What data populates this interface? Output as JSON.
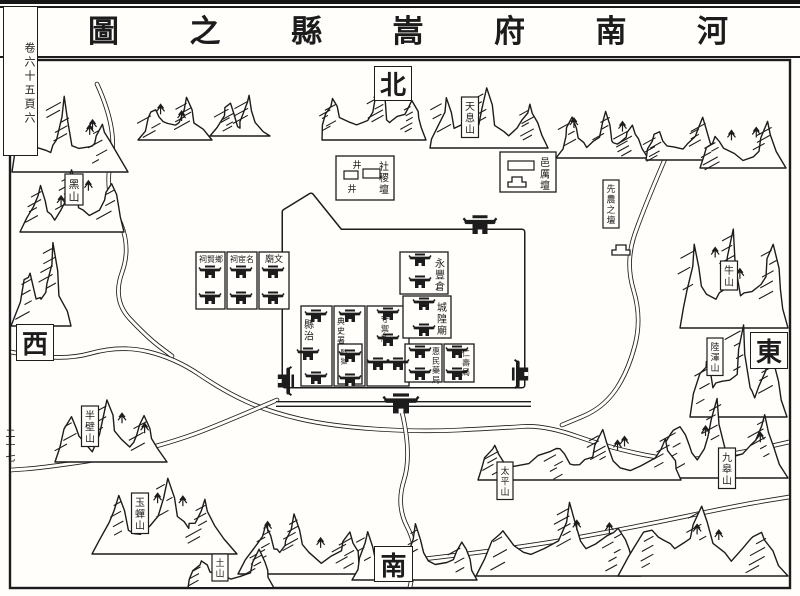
{
  "title": {
    "full": "河南府嵩縣之圖",
    "reading": "right-to-left",
    "display_chars": [
      "圖",
      "之",
      "縣",
      "嵩",
      "府",
      "南",
      "河"
    ]
  },
  "margins": {
    "folio_top": "卷六十五頁六",
    "folio_side": "二十七"
  },
  "compass": {
    "north": "北",
    "south": "南",
    "west": "西",
    "east": "東"
  },
  "ink": "#1c1c1c",
  "paper": "#fffefb",
  "map": {
    "frame": [
      10,
      60,
      780,
      528
    ],
    "wall_points": [
      [
        285,
        212
      ],
      [
        311,
        196
      ],
      [
        340,
        232
      ],
      [
        522,
        232
      ],
      [
        522,
        385
      ],
      [
        285,
        385
      ]
    ],
    "moat_points": [
      [
        276,
        404
      ],
      [
        531,
        404
      ]
    ],
    "compound_rects": [
      [
        196,
        252,
        29,
        57
      ],
      [
        227,
        252,
        30,
        57
      ],
      [
        259,
        252,
        30,
        57
      ],
      [
        301,
        306,
        31,
        80
      ],
      [
        334,
        306,
        31,
        80
      ],
      [
        367,
        306,
        42,
        80
      ],
      [
        338,
        344,
        24,
        40
      ],
      [
        400,
        252,
        48,
        42
      ],
      [
        403,
        296,
        48,
        42
      ],
      [
        405,
        344,
        37,
        38
      ],
      [
        444,
        344,
        30,
        38
      ],
      [
        336,
        156,
        58,
        44
      ],
      [
        500,
        152,
        56,
        40
      ]
    ],
    "labels_vertical": [
      {
        "t": "縣治",
        "x": 309,
        "y": 318,
        "fs": 10
      },
      {
        "t": "典史署",
        "x": 341,
        "y": 316,
        "fs": 8
      },
      {
        "t": "監獄",
        "x": 344,
        "y": 348,
        "fs": 7
      },
      {
        "t": "守禦所",
        "x": 385,
        "y": 314,
        "fs": 8
      },
      {
        "t": "永豐倉",
        "x": 440,
        "y": 257,
        "fs": 10
      },
      {
        "t": "城隍廟",
        "x": 442,
        "y": 301,
        "fs": 10
      },
      {
        "t": "惠民藥局",
        "x": 436,
        "y": 346,
        "fs": 8
      },
      {
        "t": "仁壽局",
        "x": 466,
        "y": 348,
        "fs": 8
      },
      {
        "t": "社稷壇",
        "x": 384,
        "y": 160,
        "fs": 10
      },
      {
        "t": "邑厲壇",
        "x": 545,
        "y": 156,
        "fs": 10
      }
    ],
    "labels_horizontal_rtl": [
      {
        "t": "文廟",
        "x": 274,
        "y": 262,
        "fs": 9
      },
      {
        "t": "名宦祠",
        "x": 242,
        "y": 262,
        "fs": 8
      },
      {
        "t": "鄉賢祠",
        "x": 211,
        "y": 262,
        "fs": 8
      }
    ],
    "cartouches": [
      {
        "t": "黑山",
        "x": 74,
        "y": 177,
        "fs": 11
      },
      {
        "t": "天息山",
        "x": 470,
        "y": 100,
        "fs": 10
      },
      {
        "t": "牛山",
        "x": 729,
        "y": 264,
        "fs": 10
      },
      {
        "t": "陸渾山",
        "x": 715,
        "y": 341,
        "fs": 9
      },
      {
        "t": "九皋山",
        "x": 727,
        "y": 451,
        "fs": 10
      },
      {
        "t": "太平山",
        "x": 505,
        "y": 465,
        "fs": 9
      },
      {
        "t": "半壁山",
        "x": 90,
        "y": 409,
        "fs": 10
      },
      {
        "t": "玉蟬山",
        "x": 140,
        "y": 496,
        "fs": 10
      },
      {
        "t": "土山",
        "x": 220,
        "y": 557,
        "fs": 9
      },
      {
        "t": "先農之壇",
        "x": 611,
        "y": 183,
        "fs": 9
      }
    ],
    "wells": {
      "glyph": "井",
      "positions": [
        [
          357,
          168
        ],
        [
          352,
          192
        ]
      ]
    },
    "altar_positions": [
      [
        517,
        180
      ],
      [
        621,
        248
      ]
    ],
    "small_rects": [
      [
        344,
        171,
        14,
        8
      ],
      [
        363,
        169,
        17,
        9
      ],
      [
        508,
        161,
        26,
        9
      ]
    ],
    "buildings": [
      [
        210,
        274
      ],
      [
        210,
        300
      ],
      [
        241,
        274
      ],
      [
        241,
        300
      ],
      [
        273,
        274
      ],
      [
        273,
        300
      ],
      [
        316,
        318
      ],
      [
        308,
        356
      ],
      [
        316,
        380
      ],
      [
        350,
        318
      ],
      [
        350,
        358
      ],
      [
        350,
        382
      ],
      [
        388,
        316
      ],
      [
        388,
        342
      ],
      [
        378,
        366
      ],
      [
        398,
        366
      ],
      [
        420,
        262
      ],
      [
        420,
        284
      ],
      [
        424,
        306
      ],
      [
        424,
        332
      ],
      [
        420,
        354
      ],
      [
        420,
        376
      ],
      [
        457,
        354
      ],
      [
        457,
        376
      ]
    ],
    "gates": [
      [
        480,
        228,
        1.5,
        0
      ],
      [
        283,
        381,
        1.3,
        90
      ],
      [
        523,
        374,
        1.3,
        -90
      ],
      [
        401,
        407,
        1.6,
        0
      ]
    ],
    "mountains": [
      [
        12,
        94,
        116,
        78,
        3,
        11,
        1
      ],
      [
        20,
        168,
        104,
        64,
        3,
        5,
        1
      ],
      [
        11,
        240,
        60,
        86,
        2,
        9,
        0
      ],
      [
        138,
        96,
        74,
        44,
        2,
        4,
        1
      ],
      [
        210,
        94,
        60,
        42,
        2,
        13,
        0
      ],
      [
        322,
        86,
        104,
        54,
        3,
        6,
        0
      ],
      [
        430,
        86,
        118,
        62,
        3,
        7,
        0
      ],
      [
        556,
        110,
        92,
        48,
        3,
        8,
        1
      ],
      [
        646,
        116,
        74,
        44,
        2,
        3,
        0
      ],
      [
        700,
        120,
        86,
        48,
        2,
        10,
        1
      ],
      [
        680,
        226,
        108,
        102,
        3,
        14,
        1
      ],
      [
        690,
        322,
        97,
        95,
        3,
        15,
        0
      ],
      [
        652,
        396,
        136,
        82,
        3,
        16,
        1
      ],
      [
        478,
        428,
        203,
        52,
        4,
        17,
        1
      ],
      [
        55,
        398,
        112,
        64,
        3,
        18,
        1
      ],
      [
        92,
        476,
        145,
        78,
        3,
        19,
        1
      ],
      [
        238,
        512,
        125,
        62,
        3,
        20,
        1
      ],
      [
        352,
        522,
        125,
        58,
        3,
        21,
        0
      ],
      [
        476,
        500,
        165,
        76,
        3,
        22,
        1
      ],
      [
        618,
        504,
        170,
        72,
        3,
        23,
        1
      ],
      [
        188,
        548,
        86,
        40,
        2,
        24,
        0
      ],
      [
        310,
        236,
        40,
        20,
        2,
        25,
        0
      ]
    ],
    "rivers": [
      [
        [
          97,
          84
        ],
        [
          118,
          130
        ],
        [
          104,
          190
        ],
        [
          132,
          245
        ],
        [
          112,
          300
        ],
        [
          148,
          338
        ],
        [
          172,
          356
        ]
      ],
      [
        [
          11,
          352
        ],
        [
          60,
          362
        ],
        [
          120,
          345
        ],
        [
          175,
          358
        ],
        [
          225,
          392
        ],
        [
          270,
          412
        ],
        [
          330,
          426
        ],
        [
          420,
          432
        ],
        [
          500,
          428
        ],
        [
          545,
          425
        ],
        [
          610,
          448
        ],
        [
          680,
          462
        ],
        [
          745,
          452
        ],
        [
          789,
          442
        ]
      ],
      [
        [
          668,
          152
        ],
        [
          645,
          205
        ],
        [
          625,
          262
        ],
        [
          642,
          318
        ],
        [
          628,
          372
        ],
        [
          603,
          408
        ],
        [
          562,
          425
        ]
      ],
      [
        [
          277,
          400
        ],
        [
          235,
          418
        ],
        [
          180,
          440
        ],
        [
          110,
          458
        ],
        [
          40,
          468
        ],
        [
          11,
          470
        ]
      ],
      [
        [
          402,
          412
        ],
        [
          412,
          455
        ],
        [
          396,
          505
        ],
        [
          418,
          548
        ],
        [
          410,
          587
        ]
      ],
      [
        [
          415,
          560
        ],
        [
          520,
          548
        ],
        [
          630,
          528
        ],
        [
          740,
          505
        ],
        [
          789,
          497
        ]
      ]
    ]
  }
}
